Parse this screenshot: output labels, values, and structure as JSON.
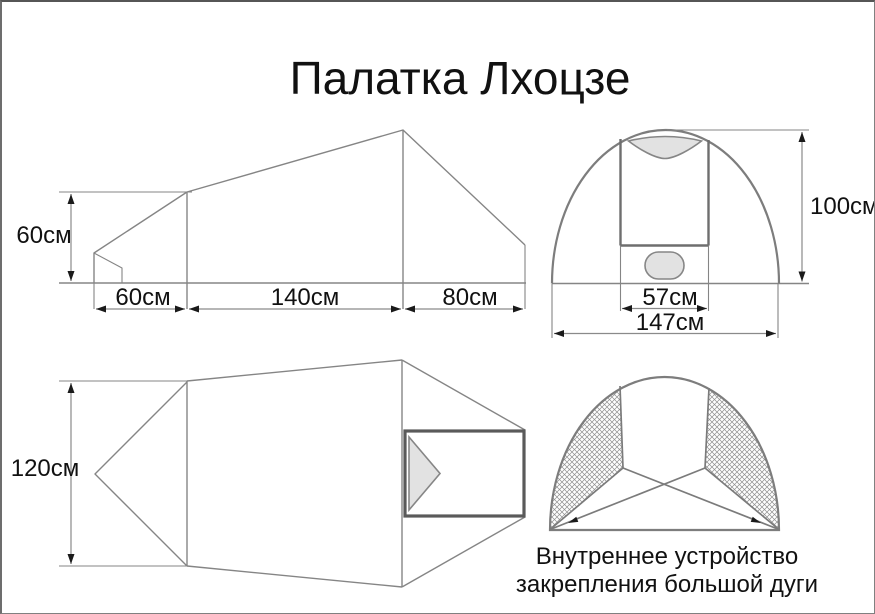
{
  "title": "Палатка Лхоцзе",
  "side_view": {
    "height_label": "60см",
    "vestibule_length_label": "60см",
    "body_length_label": "140см",
    "rear_length_label": "80см"
  },
  "front_view": {
    "height_label": "100см",
    "door_width_label": "57см",
    "total_width_label": "147см"
  },
  "top_view": {
    "width_label": "120см"
  },
  "interior_view": {
    "caption_line1": "Внутреннее устройство",
    "caption_line2": "закрепления большой дуги"
  },
  "colors": {
    "line": "#858585",
    "thickline": "#5a5a5a",
    "arrow": "#1a1a1a",
    "fillgray": "#e2e2e2",
    "text": "#111111",
    "borderc": "#808080",
    "bg": "#ffffff"
  }
}
